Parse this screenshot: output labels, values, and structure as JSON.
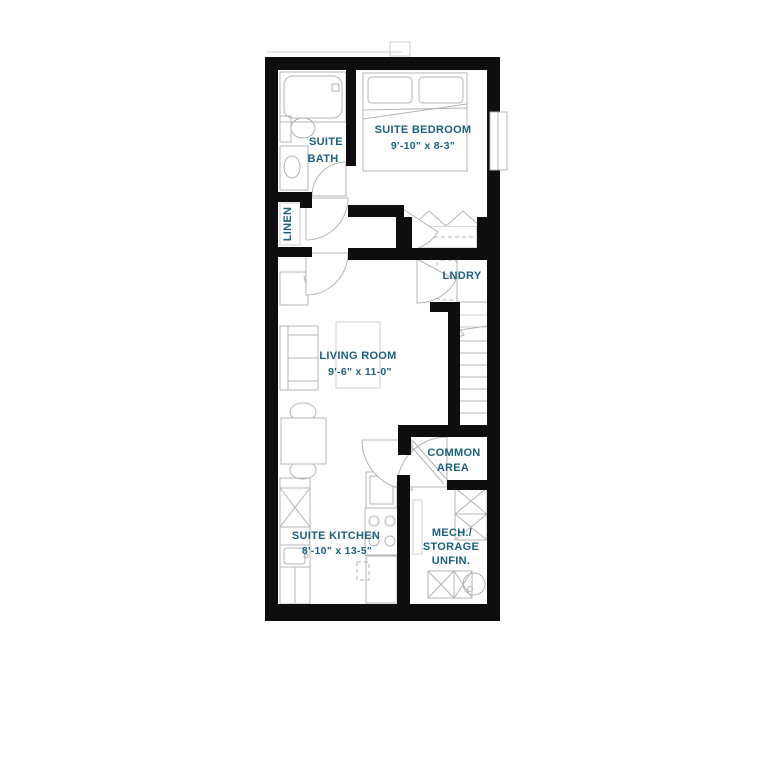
{
  "title": "Floor plan",
  "colors": {
    "wall": "#0e0e0e",
    "furniture_line": "#b4b4b4",
    "light_line": "#cfcfcf",
    "label_text": "#1c607c",
    "background": "#ffffff"
  },
  "rooms": {
    "suite_bath": {
      "line1": "SUITE",
      "line2": "BATH"
    },
    "suite_bedroom": {
      "name": "SUITE BEDROOM",
      "dims": "9'-10\" x 8-3\""
    },
    "linen": {
      "name": "LINEN"
    },
    "laundry": {
      "name": "LNDRY"
    },
    "living_room": {
      "name": "LIVING ROOM",
      "dims": "9'-6\" x 11-0\""
    },
    "common_area": {
      "line1": "COMMON",
      "line2": "AREA"
    },
    "suite_kitchen": {
      "name": "SUITE KITCHEN",
      "dims": "8'-10\" x 13-5\""
    },
    "mech_storage": {
      "line1": "MECH./",
      "line2": "STORAGE",
      "line3": "UNFIN."
    }
  }
}
